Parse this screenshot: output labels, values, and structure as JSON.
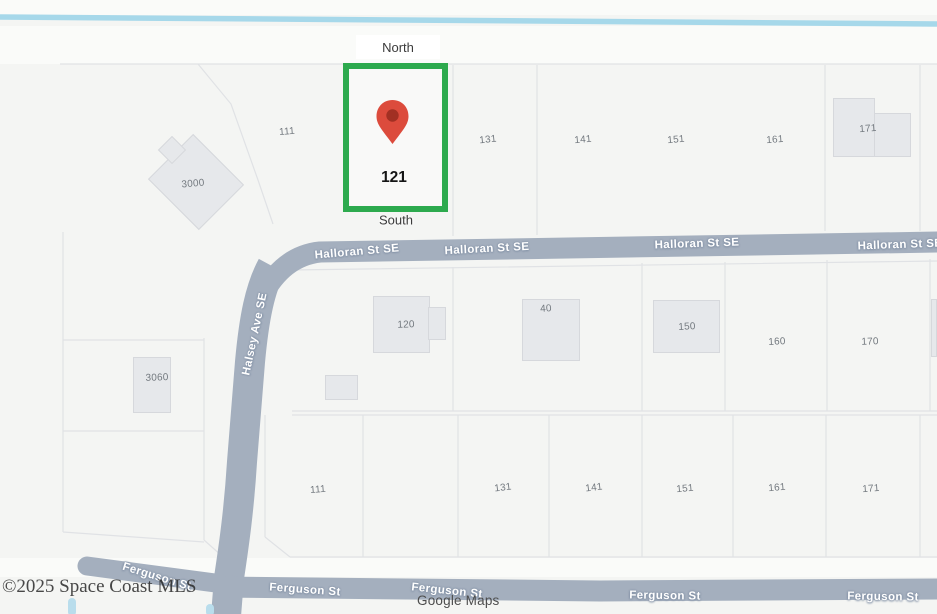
{
  "attribution": {
    "mls": "©2025 Space Coast MLS",
    "google": "Google Maps"
  },
  "compass": {
    "north": "North",
    "south": "South"
  },
  "highlighted_parcel": {
    "number": "121"
  },
  "streets": {
    "halloran": "Halloran St SE",
    "halsey": "Halsey Ave SE",
    "ferguson": "Ferguson St"
  },
  "parcels": {
    "top_row": [
      "111",
      "131",
      "141",
      "151",
      "161",
      "171"
    ],
    "middle_row": [
      "120",
      "40",
      "150",
      "160",
      "170"
    ],
    "bottom_row": [
      "111",
      "131",
      "141",
      "151",
      "161",
      "171"
    ],
    "left_column": [
      "3000",
      "3060"
    ]
  },
  "colors": {
    "bg": "#f4f5f3",
    "gap": "#fafbf9",
    "line": "#e0e2e5",
    "road": "#a4afbe",
    "roadHalo": "#8694a8",
    "water": "#a6d8ea",
    "waterLight": "#b9ddec",
    "building": "#e6e8eb",
    "buildingBorder": "#d6d8dc",
    "parcelText": "#73797f",
    "green": "#2daa4e",
    "pinBody": "#dc4b3c",
    "pinCenter": "#a23023"
  }
}
